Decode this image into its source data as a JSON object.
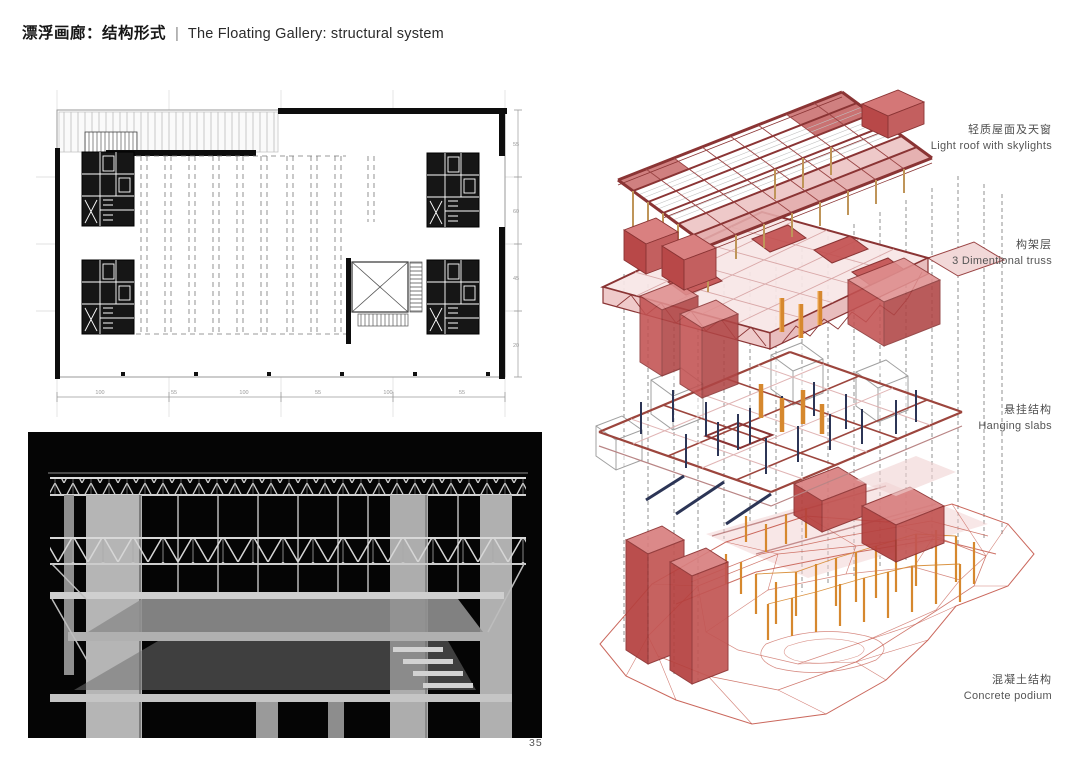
{
  "page": {
    "title_zh": "漂浮画廊：结构形式",
    "separator": "|",
    "title_en": "The Floating Gallery: structural system",
    "page_number": "35"
  },
  "exploded": {
    "layers": [
      {
        "zh": "轻质屋面及天窗",
        "en": "Light roof with skylights"
      },
      {
        "zh": "构架层",
        "en": "3 Dimentional truss"
      },
      {
        "zh": "悬挂结构",
        "en": "Hanging slabs"
      },
      {
        "zh": "混凝土结构",
        "en": "Concrete podium"
      }
    ]
  },
  "plan": {
    "bottom_dimensions": [
      "100",
      "55",
      "100",
      "55",
      "100",
      "55"
    ],
    "right_dimensions": [
      "55",
      "60",
      "45",
      "20"
    ]
  },
  "colors": {
    "truss_maroon": "#8a3434",
    "panel_red": "#c96060",
    "box_red": "#c4504e",
    "column_orange": "#d6882e",
    "hanger_tan": "#bf9559",
    "rod_navy": "#2c3556",
    "mesh_salmon": "#c4574a",
    "slab_pink": "#f2d6d6",
    "concrete_gray": "#b5b5b5"
  }
}
